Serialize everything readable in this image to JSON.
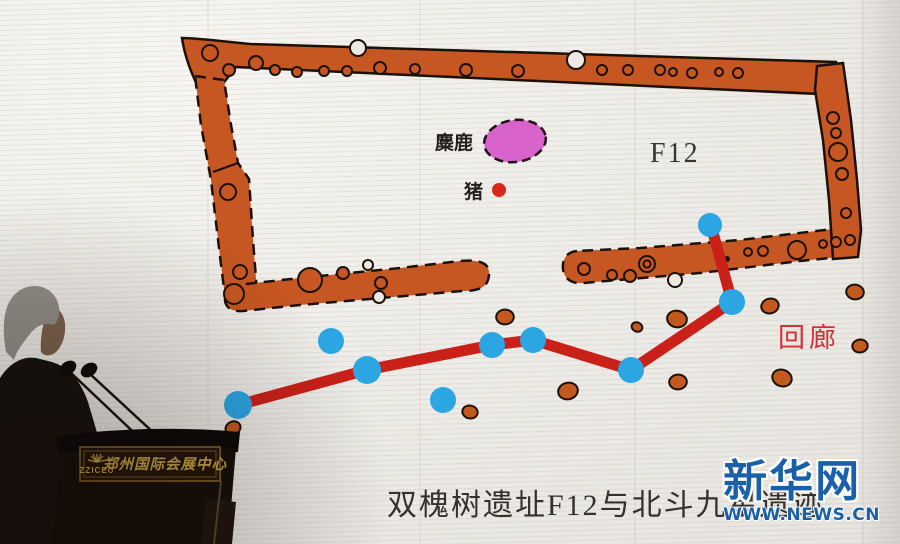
{
  "slide": {
    "caption": "双槐树遗址F12与北斗九星遗迹",
    "labels": {
      "elk": "麋鹿",
      "pig": "猪",
      "house_id": "F12",
      "corridor": "回廊"
    }
  },
  "watermark": {
    "site_name": "新华网",
    "site_url": "WWW.NEWS.CN"
  },
  "podium": {
    "venue_abbr": "ZZICEC",
    "venue_name": "郑州国际会展中心"
  },
  "colors": {
    "wall_orange": "#c75722",
    "pit_orange": "#c25a20",
    "star_blue": "#2ba6e3",
    "line_red": "#c92017",
    "elk_pink": "#d763cb",
    "pig_red": "#d6281c",
    "corridor_red": "#d3313a",
    "xinhua_blue": "#1a5fa9",
    "plaque_gold": "#c9a545"
  },
  "diagram": {
    "type": "archaeological-site-plan",
    "house_label": "F12",
    "stars": [
      {
        "x": 238,
        "y": 405,
        "r": 14
      },
      {
        "x": 331,
        "y": 341,
        "r": 13
      },
      {
        "x": 367,
        "y": 370,
        "r": 14
      },
      {
        "x": 443,
        "y": 400,
        "r": 13
      },
      {
        "x": 492,
        "y": 345,
        "r": 13
      },
      {
        "x": 533,
        "y": 340,
        "r": 13
      },
      {
        "x": 631,
        "y": 370,
        "r": 13
      },
      {
        "x": 732,
        "y": 302,
        "r": 13
      },
      {
        "x": 710,
        "y": 225,
        "r": 12
      }
    ],
    "line_path": [
      [
        238,
        405
      ],
      [
        367,
        370
      ],
      [
        492,
        345
      ],
      [
        533,
        340
      ],
      [
        631,
        370
      ],
      [
        732,
        302
      ],
      [
        712,
        229
      ]
    ],
    "pits": [
      {
        "x": 233,
        "y": 428,
        "r": 7
      },
      {
        "x": 470,
        "y": 412,
        "r": 7
      },
      {
        "x": 505,
        "y": 317,
        "r": 8
      },
      {
        "x": 568,
        "y": 391,
        "r": 9
      },
      {
        "x": 637,
        "y": 327,
        "r": 5
      },
      {
        "x": 677,
        "y": 319,
        "r": 9
      },
      {
        "x": 678,
        "y": 382,
        "r": 8
      },
      {
        "x": 770,
        "y": 306,
        "r": 8
      },
      {
        "x": 782,
        "y": 378,
        "r": 9
      },
      {
        "x": 855,
        "y": 292,
        "r": 8
      },
      {
        "x": 860,
        "y": 346,
        "r": 7
      }
    ],
    "postholes": [
      {
        "x": 210,
        "y": 53,
        "r": 8
      },
      {
        "x": 229,
        "y": 70,
        "r": 6
      },
      {
        "x": 256,
        "y": 63,
        "r": 7
      },
      {
        "x": 275,
        "y": 70,
        "r": 5
      },
      {
        "x": 297,
        "y": 72,
        "r": 5
      },
      {
        "x": 324,
        "y": 71,
        "r": 5
      },
      {
        "x": 347,
        "y": 71,
        "r": 5
      },
      {
        "x": 358,
        "y": 48,
        "r": 8,
        "fill": "white"
      },
      {
        "x": 380,
        "y": 68,
        "r": 6
      },
      {
        "x": 415,
        "y": 69,
        "r": 5
      },
      {
        "x": 466,
        "y": 70,
        "r": 6
      },
      {
        "x": 518,
        "y": 71,
        "r": 6
      },
      {
        "x": 576,
        "y": 60,
        "r": 9,
        "fill": "white"
      },
      {
        "x": 602,
        "y": 70,
        "r": 5
      },
      {
        "x": 628,
        "y": 70,
        "r": 5
      },
      {
        "x": 660,
        "y": 70,
        "r": 5
      },
      {
        "x": 673,
        "y": 72,
        "r": 4
      },
      {
        "x": 692,
        "y": 73,
        "r": 5
      },
      {
        "x": 719,
        "y": 72,
        "r": 4
      },
      {
        "x": 738,
        "y": 73,
        "r": 5
      },
      {
        "x": 833,
        "y": 118,
        "r": 6
      },
      {
        "x": 836,
        "y": 133,
        "r": 5
      },
      {
        "x": 838,
        "y": 152,
        "r": 9
      },
      {
        "x": 842,
        "y": 174,
        "r": 6
      },
      {
        "x": 846,
        "y": 213,
        "r": 5
      },
      {
        "x": 850,
        "y": 240,
        "r": 5
      },
      {
        "x": 836,
        "y": 242,
        "r": 5
      },
      {
        "x": 823,
        "y": 244,
        "r": 4
      },
      {
        "x": 797,
        "y": 250,
        "r": 9
      },
      {
        "x": 763,
        "y": 251,
        "r": 5
      },
      {
        "x": 748,
        "y": 252,
        "r": 4
      },
      {
        "x": 727,
        "y": 259,
        "r": 3,
        "fill": "dark"
      },
      {
        "x": 647,
        "y": 264,
        "r": 8,
        "ring": true
      },
      {
        "x": 630,
        "y": 276,
        "r": 6
      },
      {
        "x": 612,
        "y": 275,
        "r": 5
      },
      {
        "x": 584,
        "y": 269,
        "r": 6
      },
      {
        "x": 675,
        "y": 280,
        "r": 7,
        "fill": "white"
      },
      {
        "x": 240,
        "y": 272,
        "r": 7
      },
      {
        "x": 234,
        "y": 294,
        "r": 10
      },
      {
        "x": 310,
        "y": 280,
        "r": 12
      },
      {
        "x": 343,
        "y": 273,
        "r": 6
      },
      {
        "x": 368,
        "y": 265,
        "r": 5,
        "fill": "white"
      },
      {
        "x": 381,
        "y": 283,
        "r": 6
      },
      {
        "x": 379,
        "y": 297,
        "r": 6,
        "fill": "white"
      },
      {
        "x": 228,
        "y": 192,
        "r": 8
      }
    ],
    "elk_pit": {
      "cx": 515,
      "cy": 141,
      "rx": 31,
      "ry": 21,
      "rotate": -8
    },
    "pig_pit": {
      "cx": 499,
      "cy": 190,
      "r": 7
    }
  }
}
